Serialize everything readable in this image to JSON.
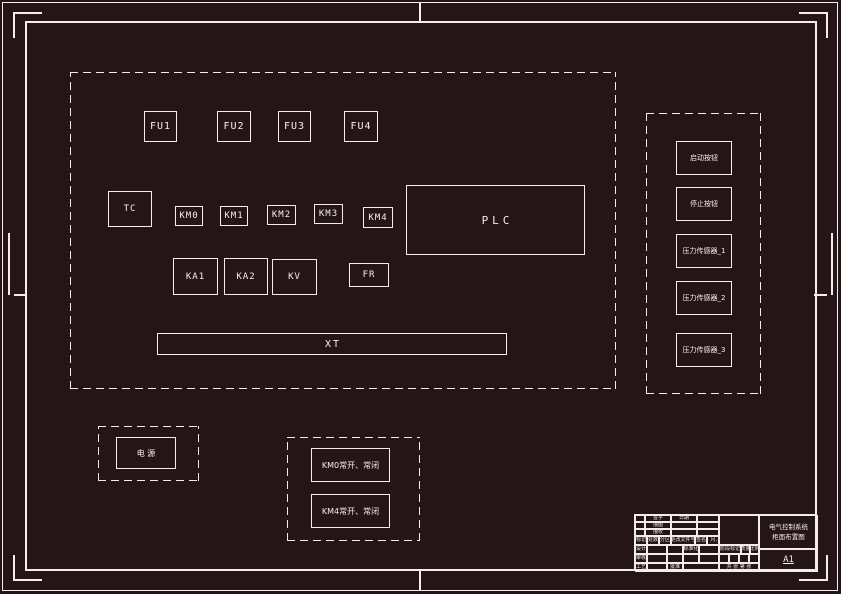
{
  "drawing": {
    "background": "#261518",
    "line_color": "#f3efe8"
  },
  "cabinet": {
    "fuses": [
      "FU1",
      "FU2",
      "FU3",
      "FU4"
    ],
    "transformer": "TC",
    "contactors": [
      "KM0",
      "KM1",
      "KM2",
      "KM3",
      "KM4"
    ],
    "plc": "PLC",
    "relays": [
      "KA1",
      "KA2"
    ],
    "voltage_relay": "KV",
    "thermal_relay": "FR",
    "terminal_block": "XT"
  },
  "door_panel": {
    "items": [
      "启动按钮",
      "停止按钮",
      "压力传感器_1",
      "压力传感器_2",
      "压力传感器_3"
    ]
  },
  "power_box": {
    "label": "电 源"
  },
  "aux_panel": {
    "items": [
      "KM0常开、常闭",
      "KM4常开、常闭"
    ]
  },
  "title_block": {
    "small_rows": [
      [
        "签字",
        "日期"
      ],
      [
        "描图",
        ""
      ],
      [
        "描校",
        ""
      ]
    ],
    "mark_row": [
      "标记",
      "处数",
      "分区",
      "更改文件号",
      "签名",
      "年、月、日"
    ],
    "design_label": "设计",
    "standard_label": "标准化",
    "stage_label": "阶段标记",
    "mass_label": "质量",
    "scale_label": "比例",
    "check_label": "审核",
    "craft_label": "工艺",
    "approve_label": "批准",
    "sheets_label": "共 张 第 张",
    "title_line1": "电气控制系统",
    "title_line2": "柜面布置图",
    "size": "A1"
  }
}
